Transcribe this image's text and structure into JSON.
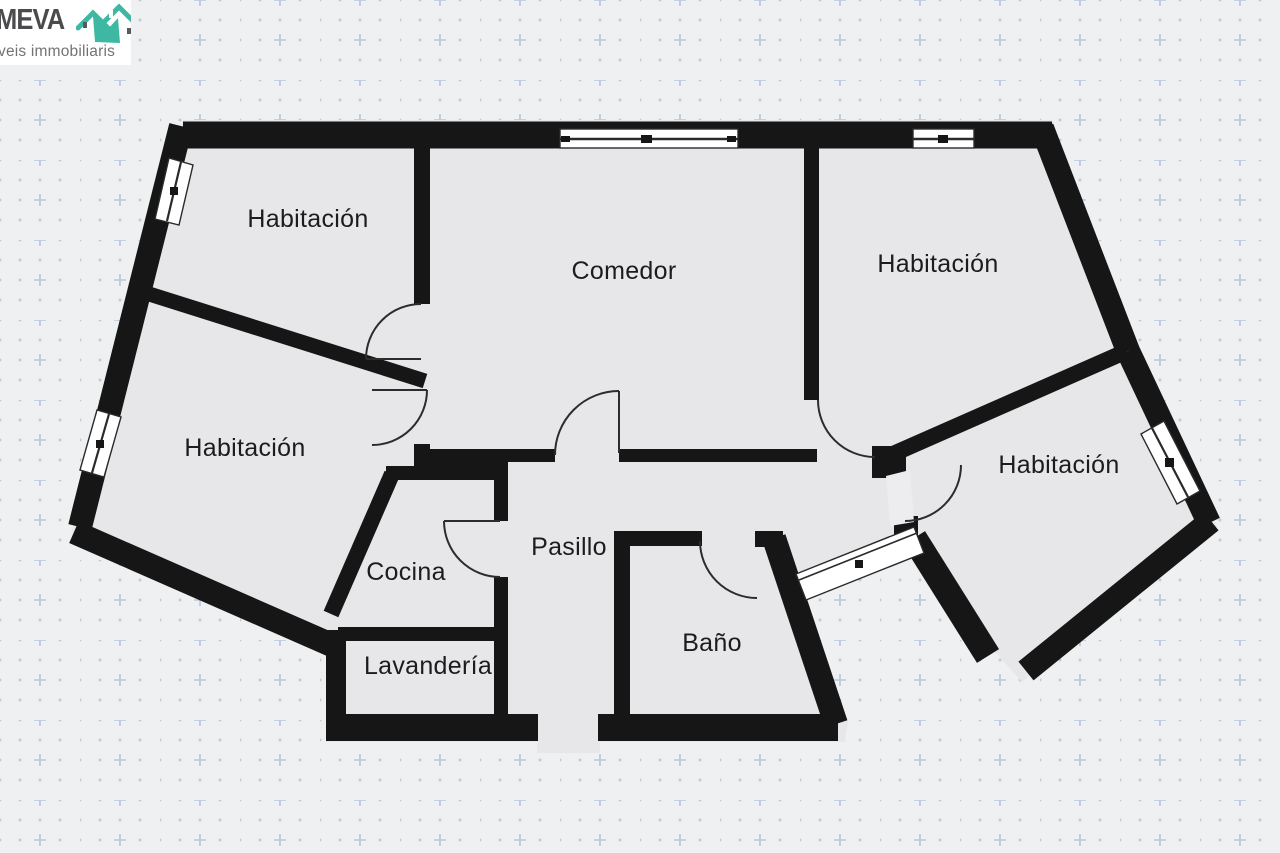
{
  "logo": {
    "brand": "MEVA",
    "tagline": "veis immobiliaris"
  },
  "floorplan": {
    "rooms": [
      {
        "id": "habitacion-nw",
        "label": "Habitación"
      },
      {
        "id": "comedor",
        "label": "Comedor"
      },
      {
        "id": "habitacion-ne",
        "label": "Habitación"
      },
      {
        "id": "habitacion-w",
        "label": "Habitación"
      },
      {
        "id": "habitacion-se",
        "label": "Habitación"
      },
      {
        "id": "cocina",
        "label": "Cocina"
      },
      {
        "id": "pasillo",
        "label": "Pasillo"
      },
      {
        "id": "lavanderia",
        "label": "Lavandería"
      },
      {
        "id": "bano",
        "label": "Baño"
      }
    ]
  },
  "colors": {
    "wall": "#161616",
    "room_fill": "#e7e7e9",
    "background": "#eef0f1",
    "window_fill": "#ffffff",
    "grid_dot": "#c7c9cc",
    "grid_plus": "#b7c5dd",
    "logo_teal": "#3eb8a2",
    "logo_text": "#4b4b4d"
  }
}
